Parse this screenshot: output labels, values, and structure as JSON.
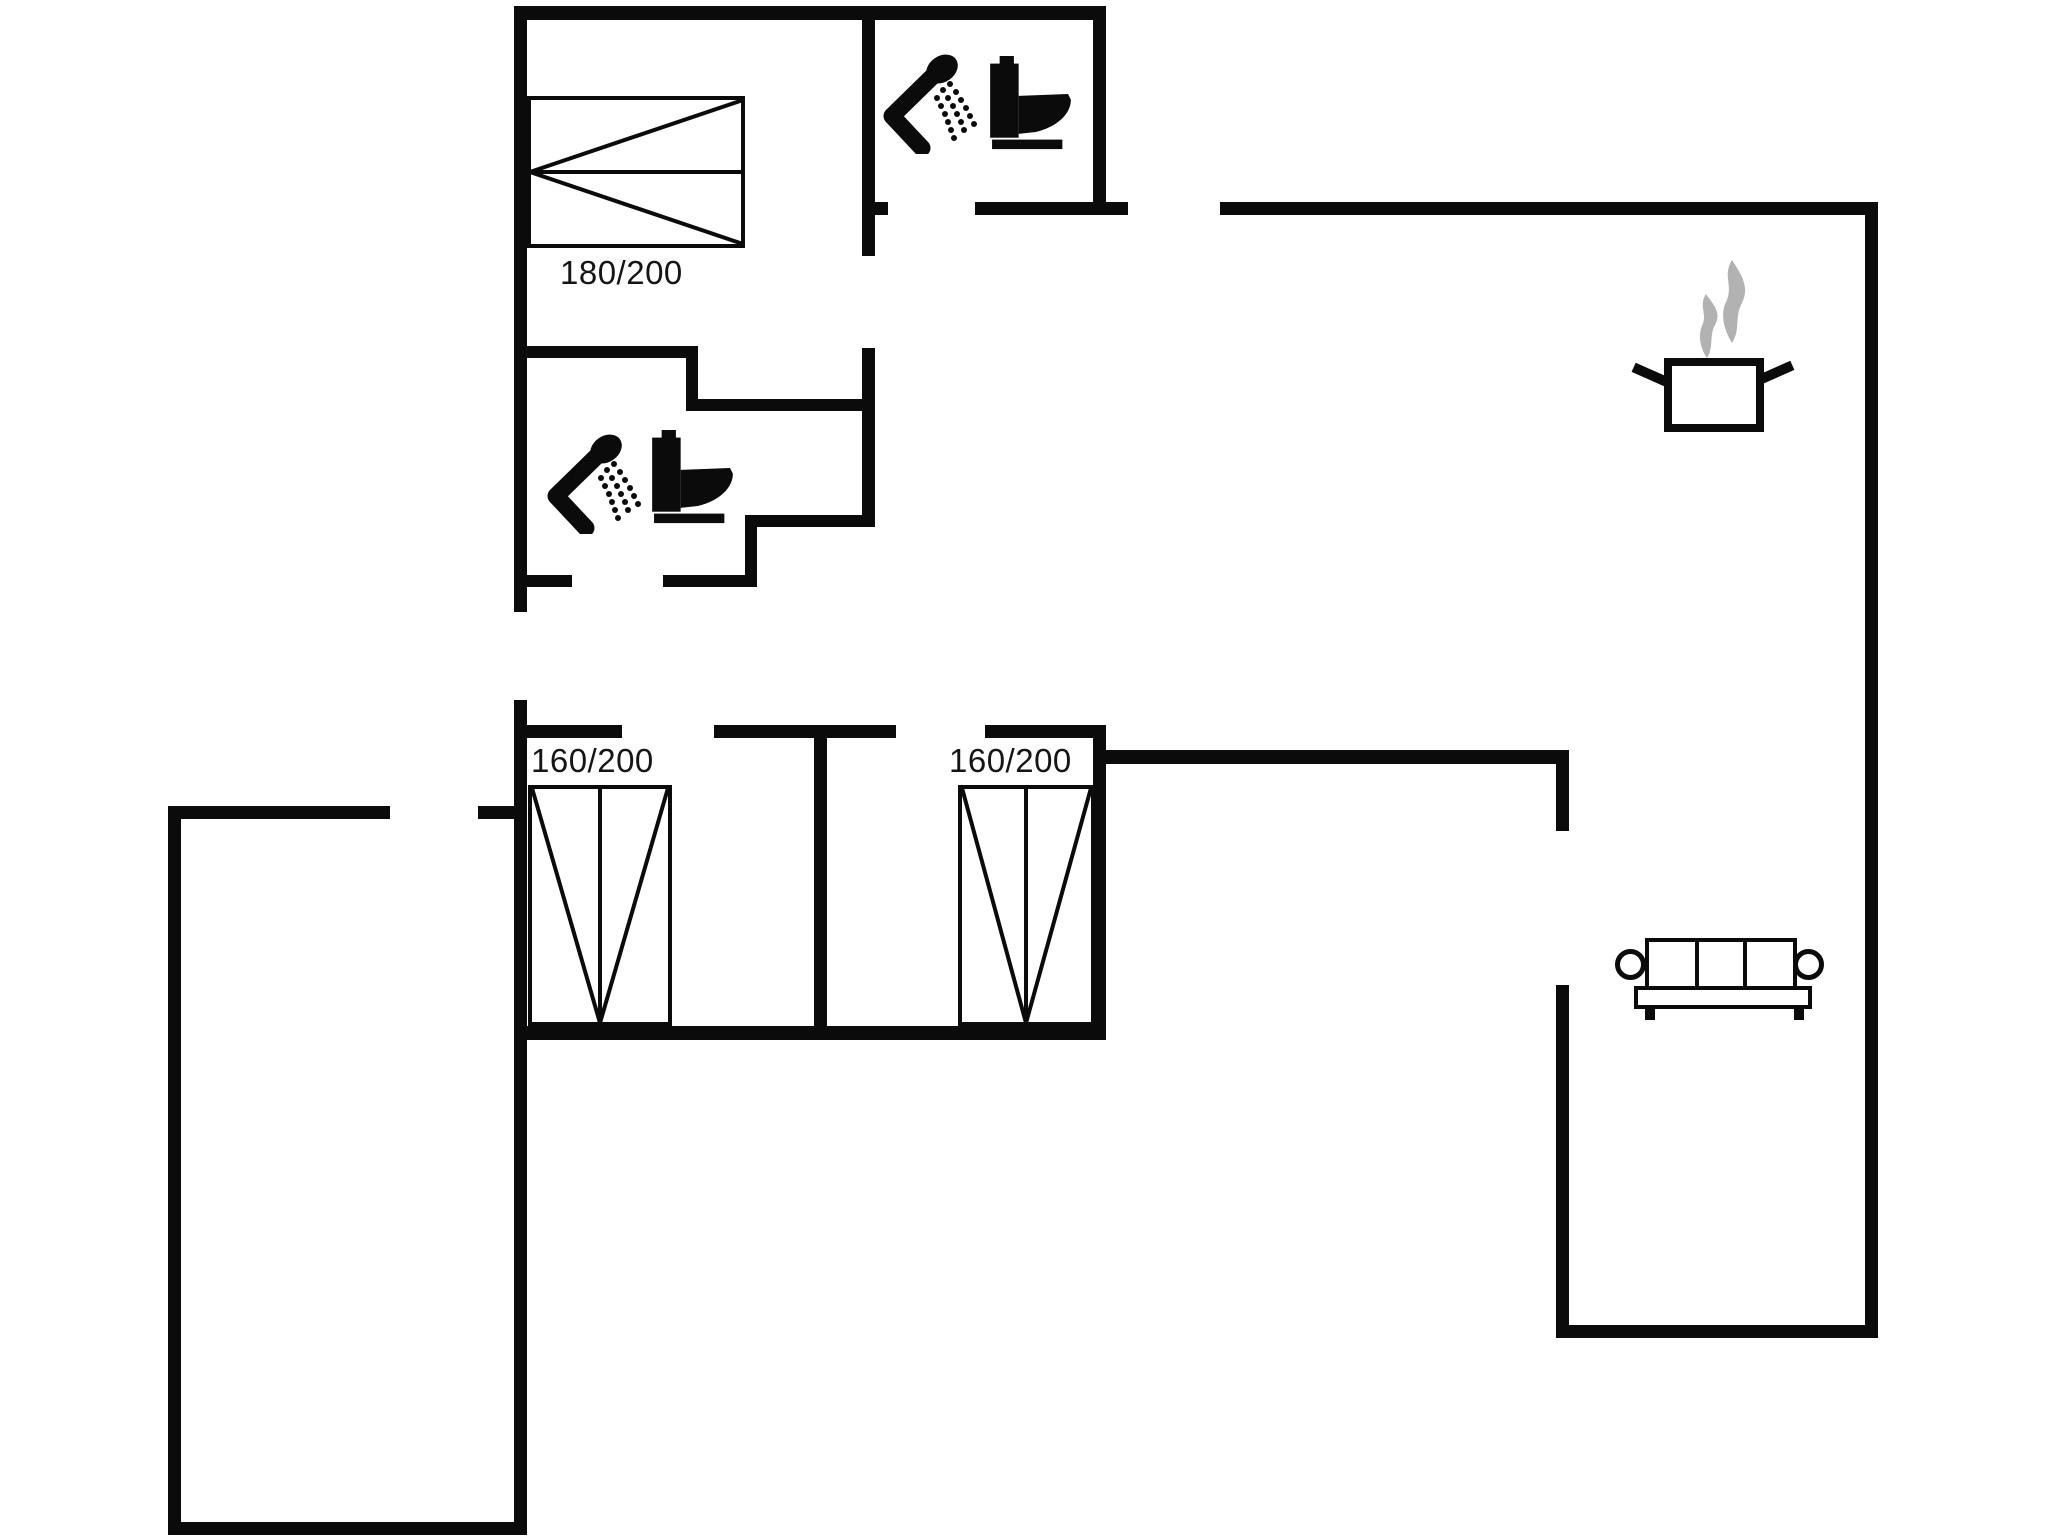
{
  "plan": {
    "type": "floor-plan",
    "labels": {
      "bed_master": "180/200",
      "bed_small_left": "160/200",
      "bed_small_right": "160/200"
    },
    "colors": {
      "wall": "#0b0b0b",
      "background": "#ffffff",
      "steam": "#b2b2b2",
      "text": "#151515"
    },
    "furniture": [
      "double-bed-180x200",
      "double-bed-160x200-left",
      "double-bed-160x200-right",
      "shower-top-bathroom",
      "toilet-top-bathroom",
      "shower-middle-bathroom",
      "toilet-middle-bathroom",
      "cooking-pot-kitchen",
      "sofa-living-room"
    ]
  }
}
